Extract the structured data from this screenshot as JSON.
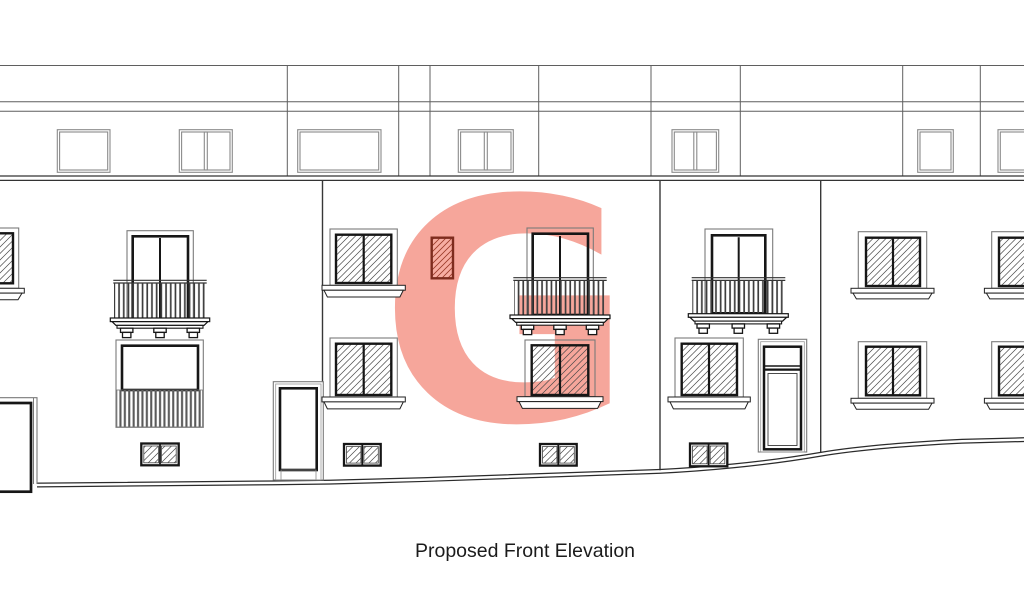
{
  "drawing": {
    "title": "Proposed Front Elevation",
    "watermark_letter": "G",
    "colors": {
      "watermark": "#f6a69b",
      "highlight_fill": "#f7ada2",
      "highlight_stroke": "#7e2c1e",
      "line_dark": "#161616",
      "line_light": "#7a7a7a",
      "background": "#ffffff"
    }
  }
}
